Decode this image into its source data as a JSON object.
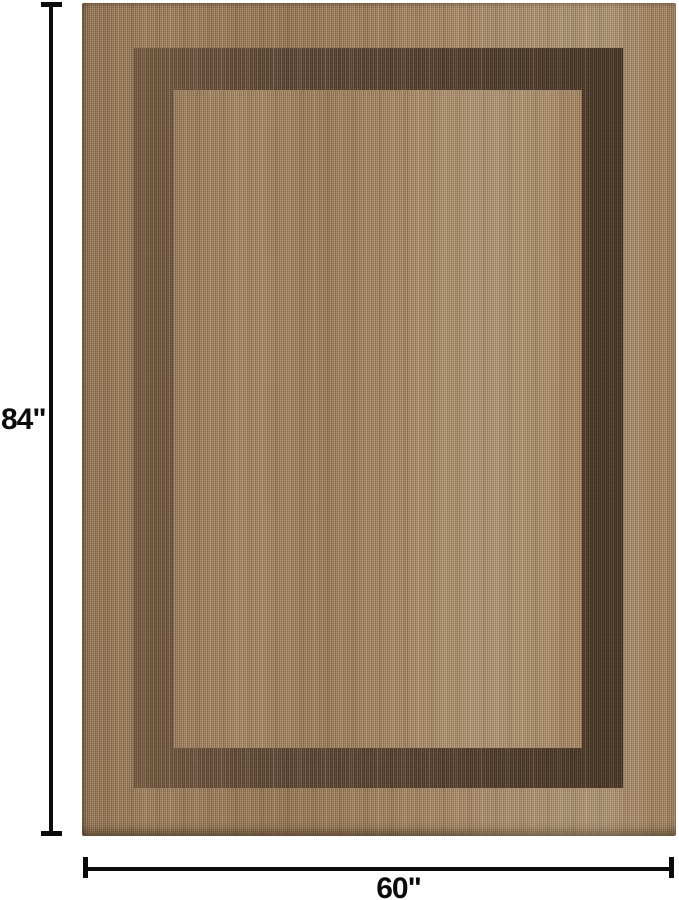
{
  "page": {
    "background_color": "#ffffff",
    "content_type": "product dimension photo"
  },
  "product": {
    "name": "bordered woven area rug",
    "description": "Tan flat-woven area rug with a wide dark brown rectangular border band near the edge"
  },
  "annotations": {
    "height": {
      "label": "84\""
    },
    "width": {
      "label": "60\""
    },
    "line_color": "#0b0b0b",
    "text_color": "#0b0b0b"
  },
  "colors": {
    "rug_outer_border": "#a68866",
    "rug_border_band": "#5c4632",
    "rug_inner_field": "#ab8d6b"
  }
}
